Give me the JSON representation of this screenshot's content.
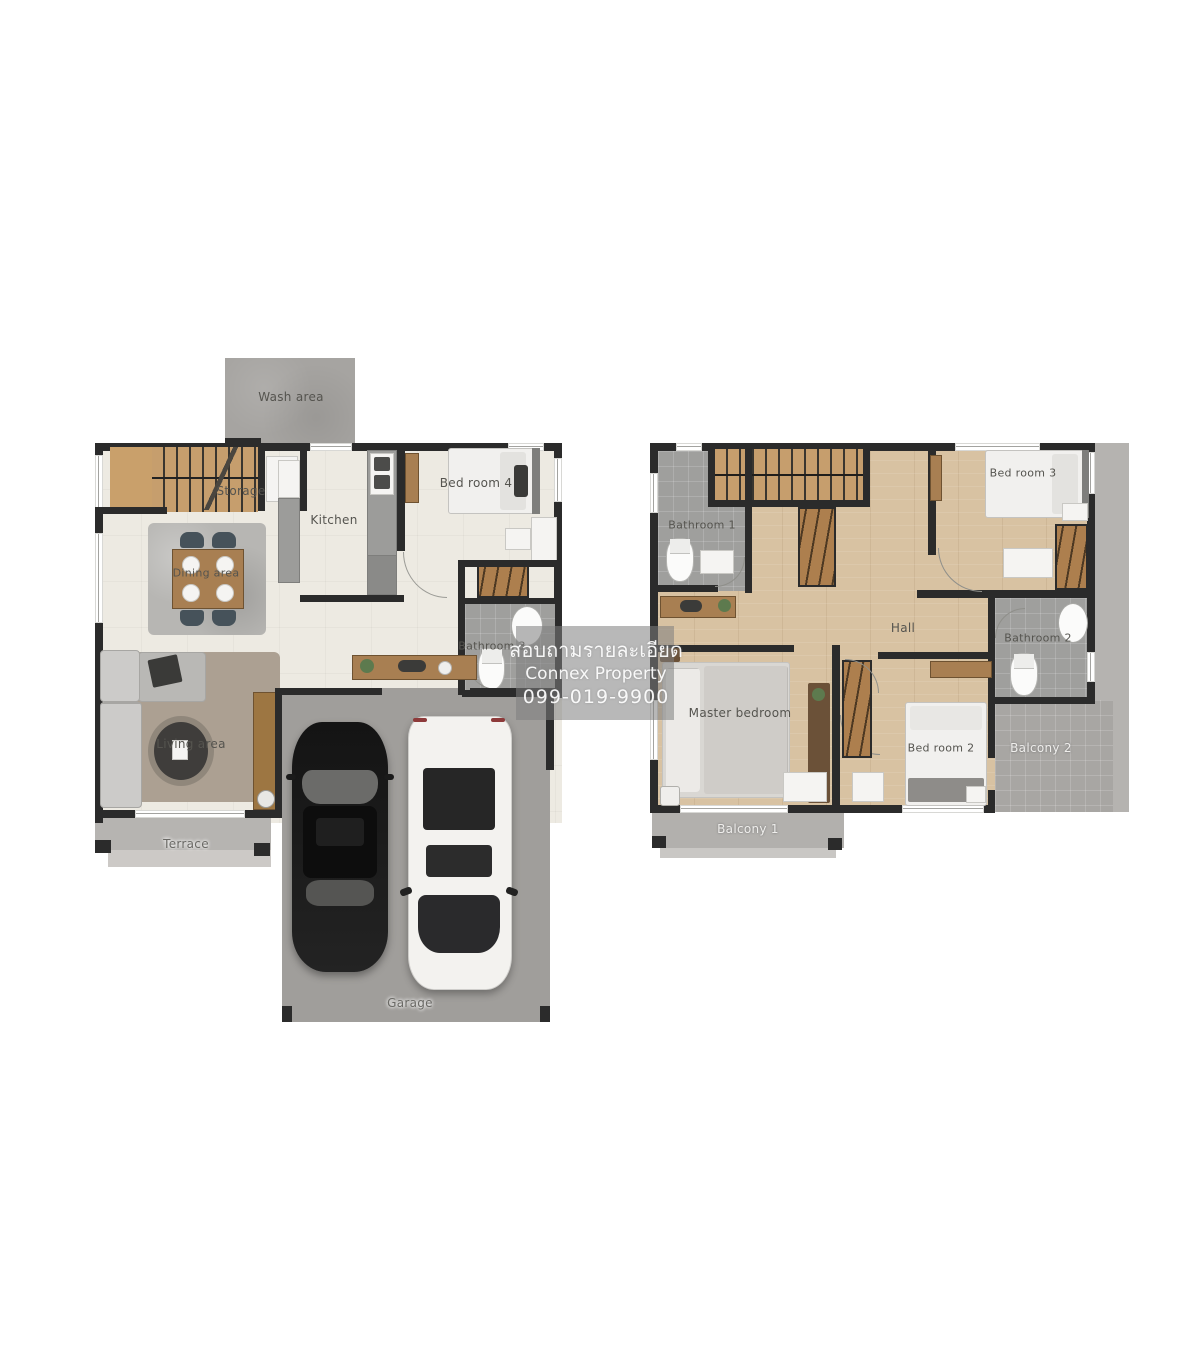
{
  "watermark": {
    "line1": "สอบถามรายละเอียด",
    "line2": "Connex Property",
    "line3": "099-019-9900"
  },
  "first_floor": {
    "wash_area": "Wash area",
    "storage": "Storage",
    "kitchen": "Kitchen",
    "bedroom4": "Bed room 4",
    "dining_area": "Dining area",
    "bathroom3": "Bathroom 3",
    "living_area": "Living area",
    "terrace": "Terrace",
    "garage": "Garage"
  },
  "second_floor": {
    "bathroom1": "Bathroom 1",
    "bedroom3": "Bed room 3",
    "hall": "Hall",
    "bathroom2": "Bathroom 2",
    "master_bedroom": "Master bedroom",
    "bedroom2": "Bed room 2",
    "balcony1": "Balcony 1",
    "balcony2": "Balcony 2"
  },
  "colors": {
    "wall": "#2b2b2b",
    "floor_first": "#edeae2",
    "floor_wood": "#d8c2a2",
    "tile_gray": "#9f9f9d",
    "concrete": "#a6a4a1",
    "stair_wood": "#c69e6d",
    "closet_wood": "#ad7f4e",
    "watermark_overlay": "rgba(125,125,125,0.55)"
  }
}
